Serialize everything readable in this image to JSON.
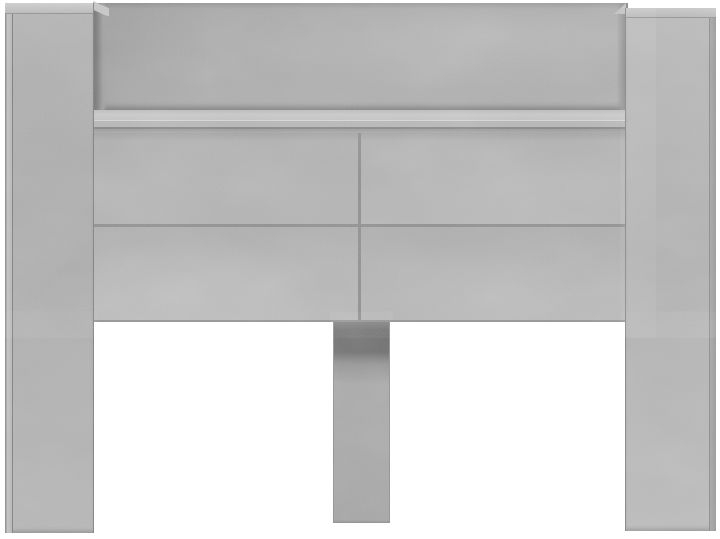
{
  "scene": {
    "description": "Front view of a concrete-grey headboard cabinet: two tall side pillars, a top storage niche with shelf, four flat cabinet doors in a 2x2 grid, and a centre support leg, on a plain white background",
    "type": "product-photo",
    "object": "headboard-cabinet",
    "finish": "concrete-grey",
    "parts": [
      "left-pillar",
      "right-pillar",
      "niche-back-panel",
      "niche-left-wall",
      "niche-right-wall",
      "shelf",
      "door-top-left",
      "door-top-right",
      "door-bottom-left",
      "door-bottom-right",
      "center-leg"
    ]
  },
  "palette": {
    "bg": "#ffffff",
    "concrete-mid": "#ababab",
    "concrete-light": "#c4c4c4",
    "concrete-lighter": "#cacaca",
    "concrete-dark": "#8a8a8a",
    "shadow-dark": "#6c6c6c",
    "edge-line": "#848484",
    "divider-line": "#8d8d8d",
    "shelf-highlight": "#d3d3d3"
  }
}
